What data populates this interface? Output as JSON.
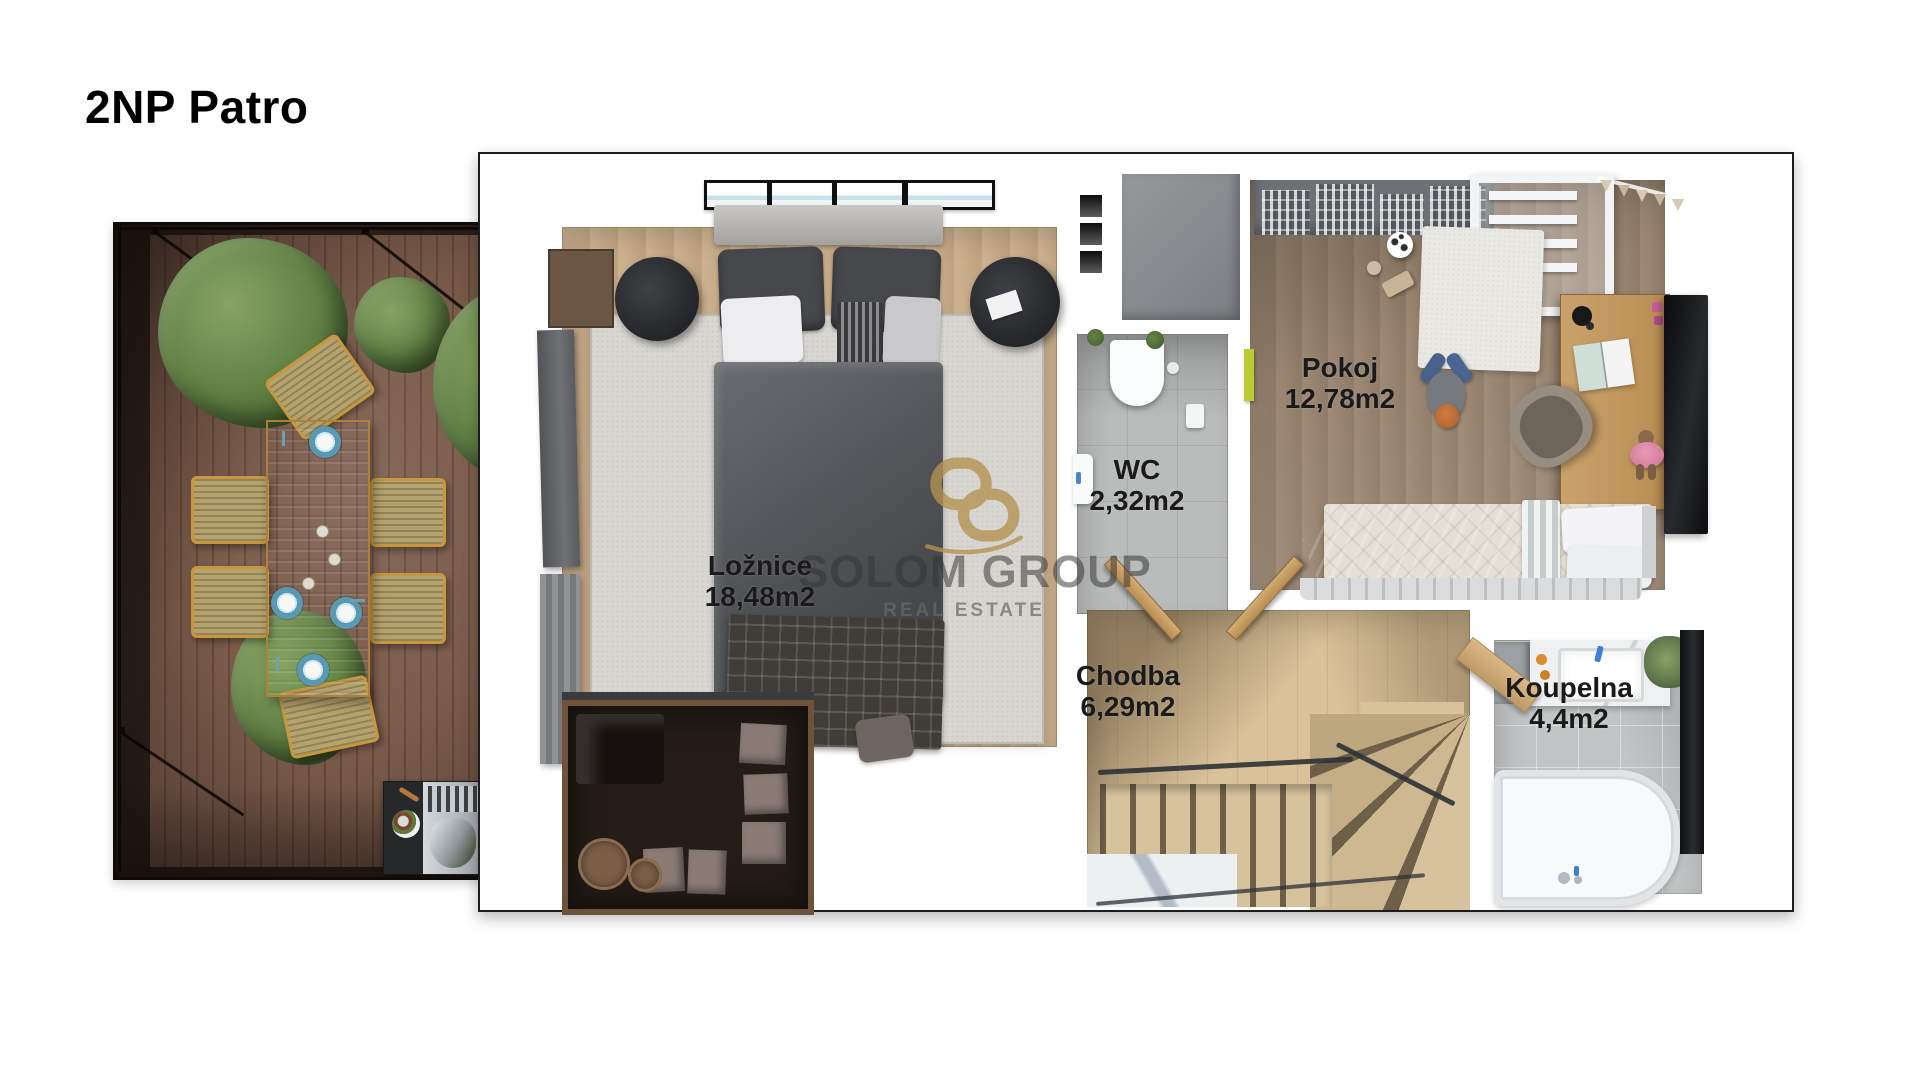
{
  "page": {
    "title": "2NP Patro"
  },
  "floorplan": {
    "rooms": [
      {
        "id": "loznice",
        "label": "Ložnice",
        "area": "18,48m2"
      },
      {
        "id": "wc",
        "label": "WC",
        "area": "2,32m2"
      },
      {
        "id": "pokoj",
        "label": "Pokoj",
        "area": "12,78m2"
      },
      {
        "id": "chodba",
        "label": "Chodba",
        "area": "6,29m2"
      },
      {
        "id": "koupelna",
        "label": "Koupelna",
        "area": "4,4m2"
      }
    ]
  },
  "watermark": {
    "brand": "SOLOM GROUP",
    "subtitle": "REAL ESTATE",
    "logo_color": "#b3924f"
  }
}
